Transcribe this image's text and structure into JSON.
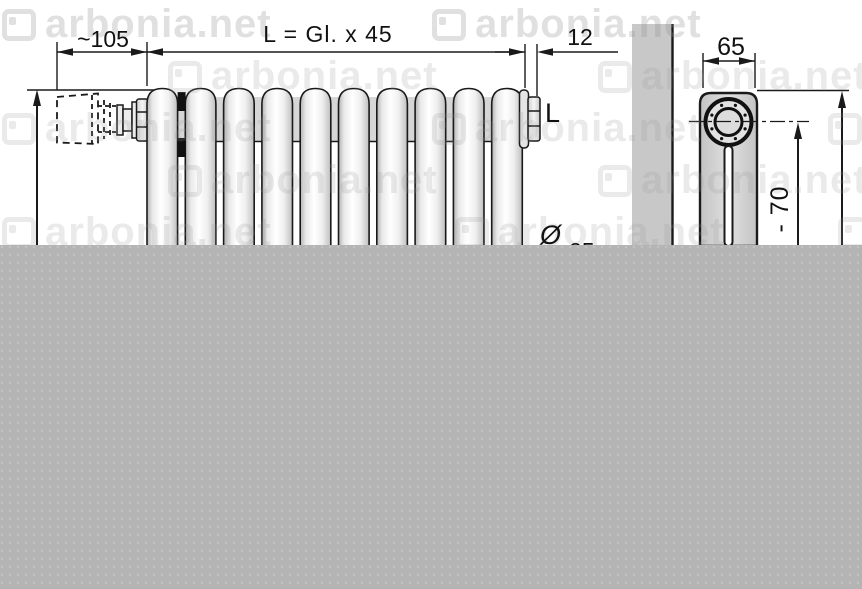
{
  "watermark": {
    "text": "arbonia.net"
  },
  "front_view": {
    "dim_valve": "~105",
    "dim_length": "L = Gl. x 45",
    "dim_end": "12",
    "connection_label": "L",
    "tube_diameter_symbol": "Ø",
    "tube_diameter_value": "25"
  },
  "side_view": {
    "dim_depth": "65",
    "dim_center_height": "- 70"
  },
  "colors": {
    "line": "#1a1a1a",
    "wall_gray": "#c8c8c8",
    "overlay_gray": "#b4b4b4",
    "watermark_gray": "#e6e6e6",
    "tube_fill": "#f2f2f2",
    "column_fill": "#d4d4d4"
  }
}
